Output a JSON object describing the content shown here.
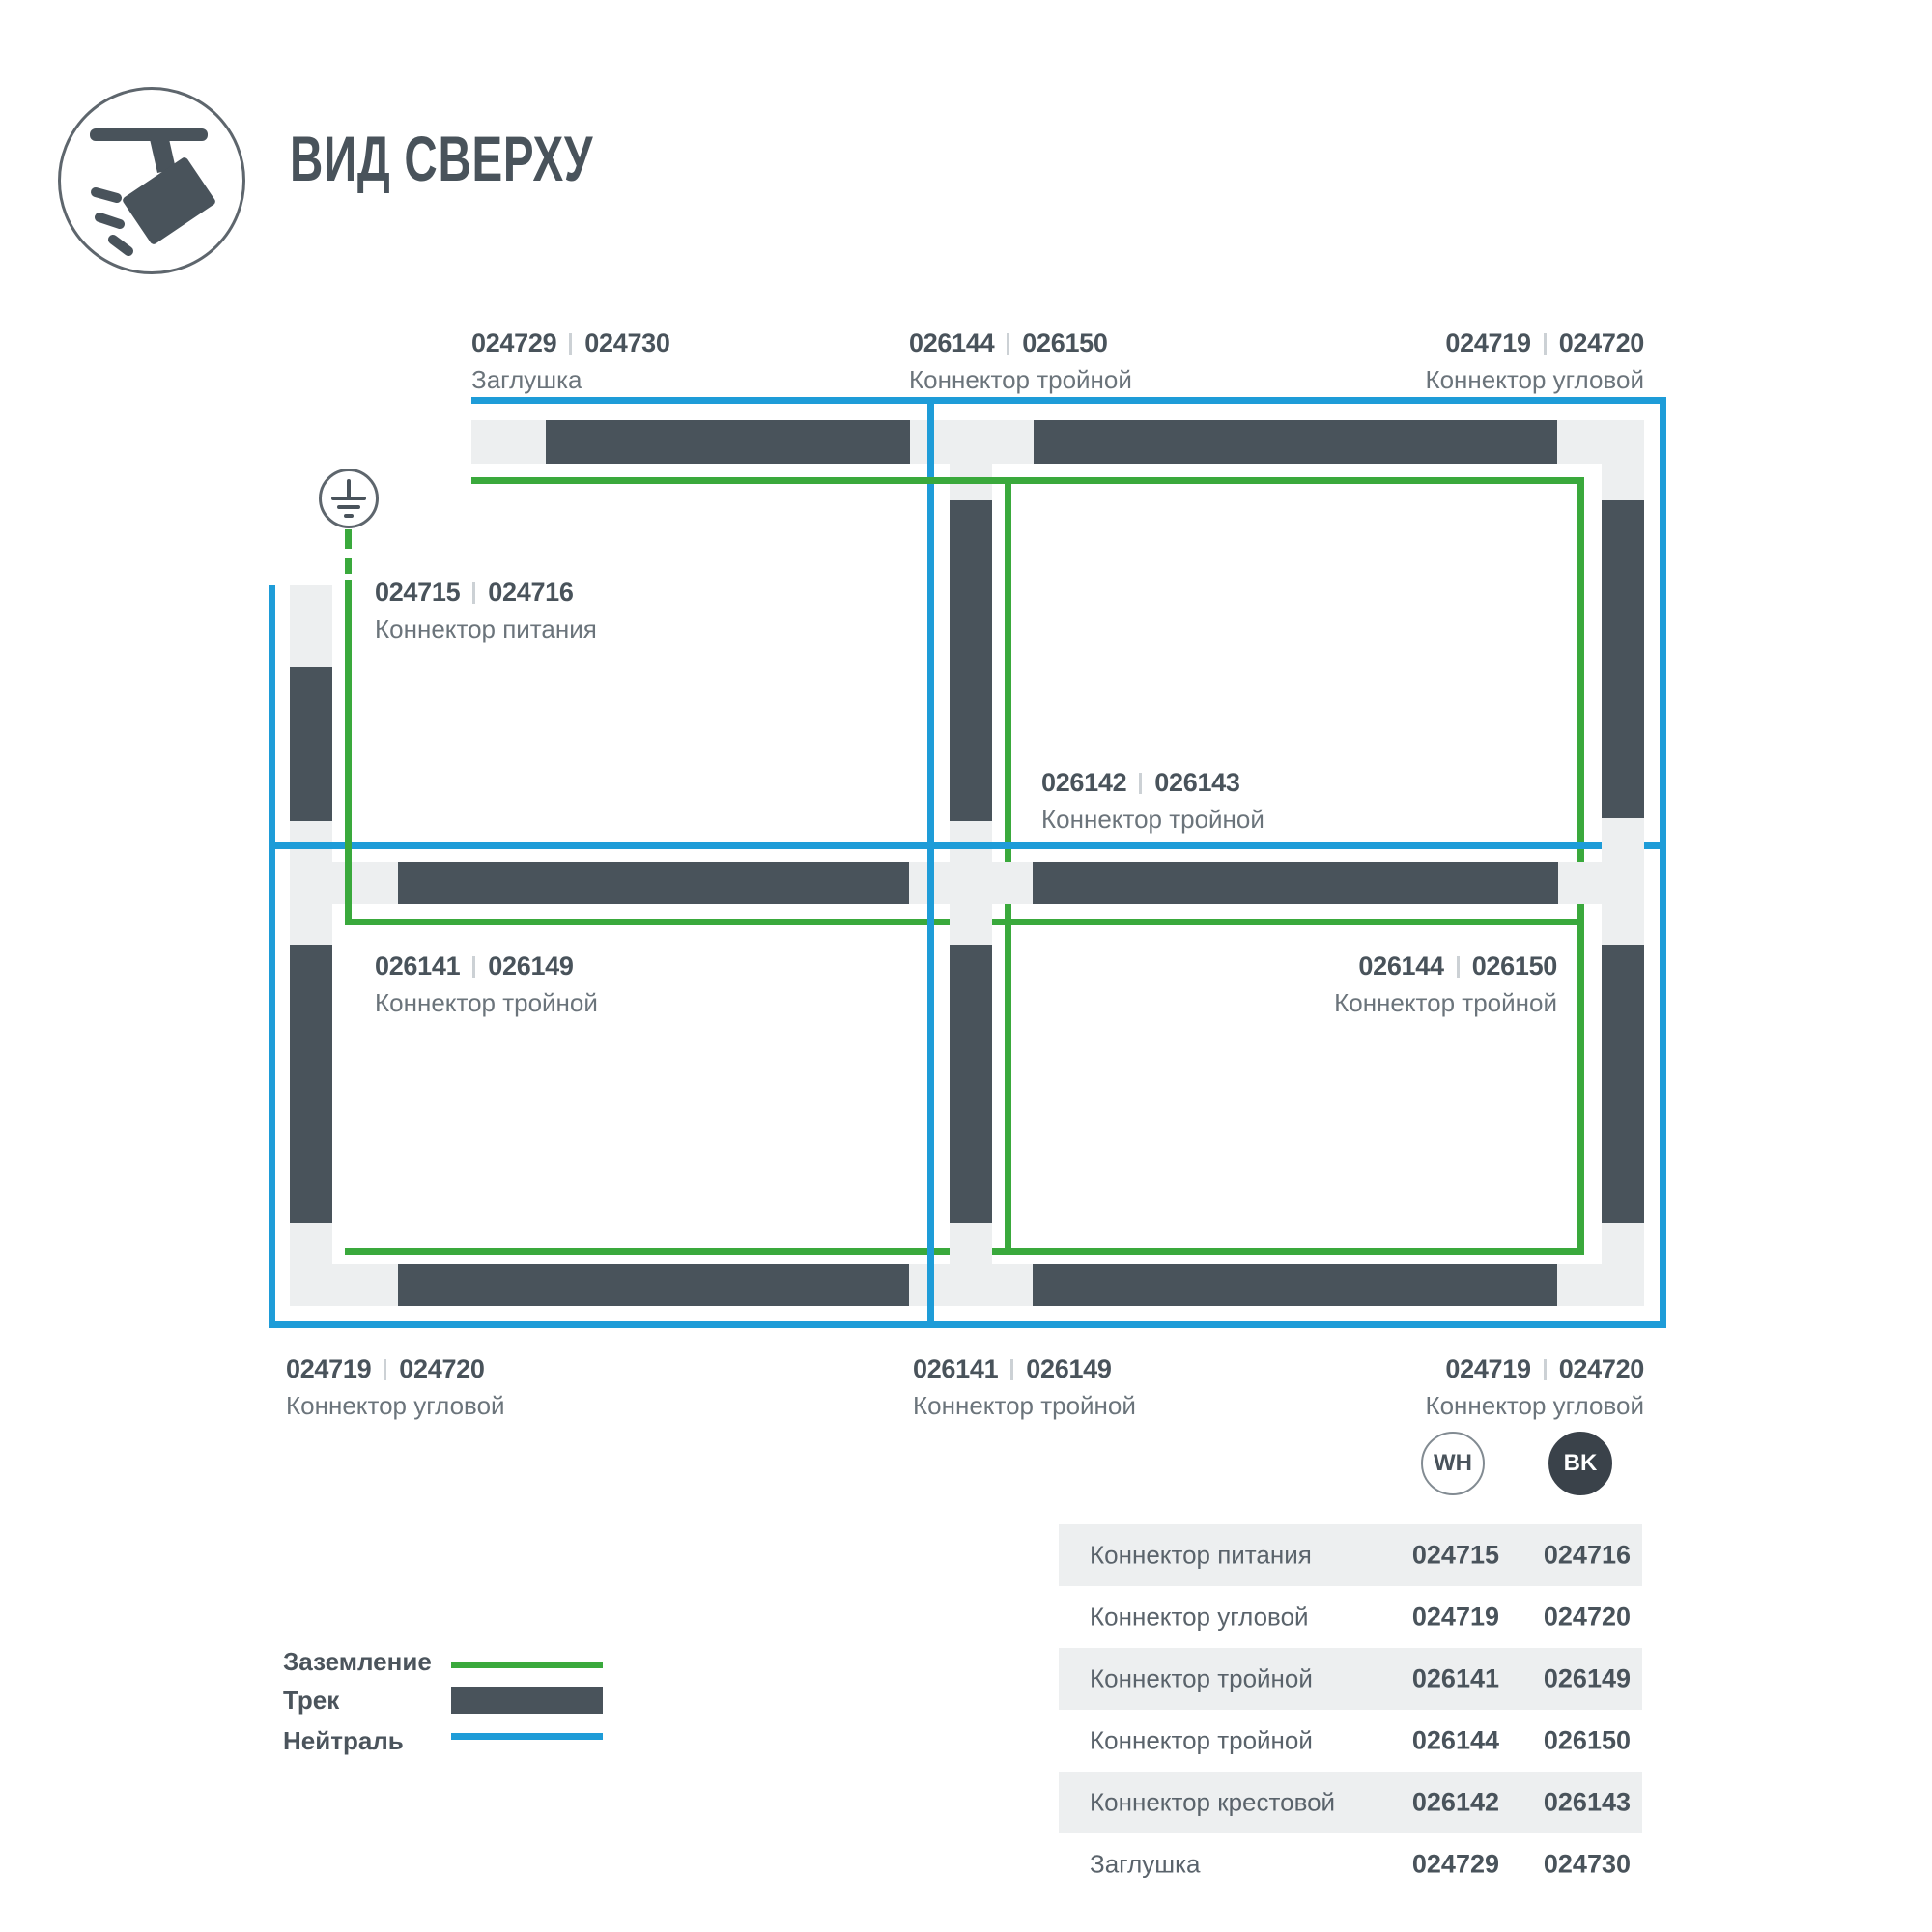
{
  "header": {
    "title": "ВИД СВЕРХУ"
  },
  "diagram": {
    "labels": [
      {
        "wh": "024729",
        "bk": "024730",
        "name": "Заглушка"
      },
      {
        "wh": "026144",
        "bk": "026150",
        "name": "Коннектор тройной"
      },
      {
        "wh": "024719",
        "bk": "024720",
        "name": "Коннектор угловой"
      },
      {
        "wh": "024715",
        "bk": "024716",
        "name": "Коннектор питания"
      },
      {
        "wh": "026142",
        "bk": "026143",
        "name": "Коннектор тройной"
      },
      {
        "wh": "026141",
        "bk": "026149",
        "name": "Коннектор тройной"
      },
      {
        "wh": "026144",
        "bk": "026150",
        "name": "Коннектор тройной"
      },
      {
        "wh": "024719",
        "bk": "024720",
        "name": "Коннектор угловой"
      },
      {
        "wh": "026141",
        "bk": "026149",
        "name": "Коннектор тройной"
      },
      {
        "wh": "024719",
        "bk": "024720",
        "name": "Коннектор угловой"
      }
    ]
  },
  "legend": {
    "items": [
      {
        "label": "Заземление",
        "type": "ground-line"
      },
      {
        "label": "Трек",
        "type": "track"
      },
      {
        "label": "Нейтраль",
        "type": "neutral-line"
      }
    ]
  },
  "colorway": {
    "wh_label": "WH",
    "bk_label": "BK"
  },
  "table": {
    "rows": [
      {
        "name": "Коннектор питания",
        "wh": "024715",
        "bk": "024716"
      },
      {
        "name": "Коннектор угловой",
        "wh": "024719",
        "bk": "024720"
      },
      {
        "name": "Коннектор тройной",
        "wh": "026141",
        "bk": "026149"
      },
      {
        "name": "Коннектор тройной",
        "wh": "026144",
        "bk": "026150"
      },
      {
        "name": "Коннектор крестовой",
        "wh": "026142",
        "bk": "026143"
      },
      {
        "name": "Заглушка",
        "wh": "024729",
        "bk": "024730"
      }
    ]
  },
  "colors": {
    "track": "#49535b",
    "rail": "#edeff0",
    "ground": "#3aa93c",
    "neutral": "#1e9cd8"
  }
}
